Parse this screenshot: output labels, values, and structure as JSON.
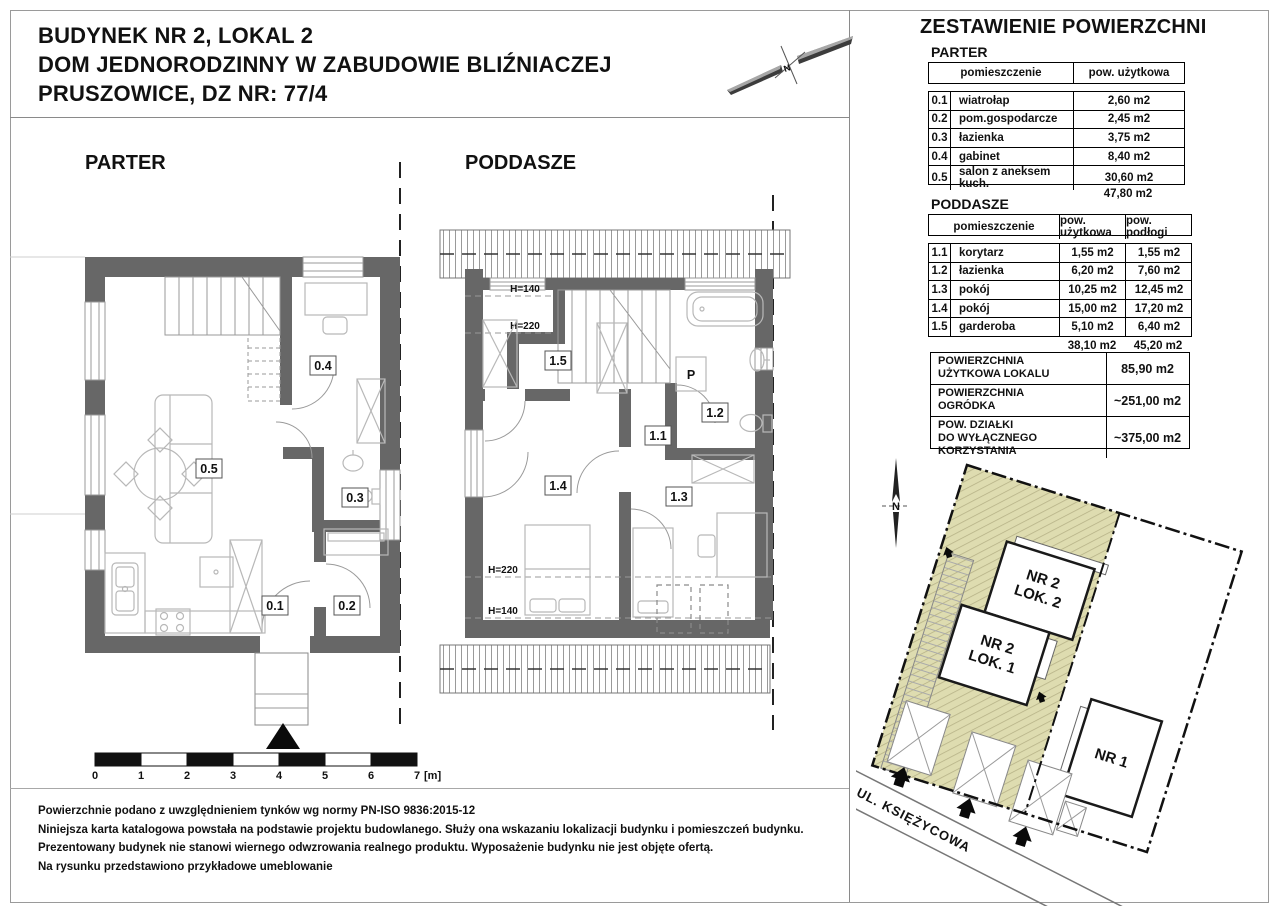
{
  "header": {
    "title_line1": "BUDYNEK NR 2, LOKAL 2",
    "title_line2": "DOM JEDNORODZINNY W ZABUDOWIE BLIŹNIACZEJ",
    "title_line3": "PRUSZOWICE, DZ NR: 77/4"
  },
  "floor_plans": {
    "parter_title": "PARTER",
    "poddasze_title": "PODDASZE",
    "parter_room_numbers": [
      "0.1",
      "0.2",
      "0.3",
      "0.4",
      "0.5"
    ],
    "poddasze_room_numbers": [
      "1.1",
      "1.2",
      "1.3",
      "1.4",
      "1.5"
    ],
    "washer_label": "P",
    "h140": "H=140",
    "h220": "H=220"
  },
  "scale_bar": {
    "ticks": [
      "0",
      "1",
      "2",
      "3",
      "4",
      "5",
      "6",
      "7"
    ],
    "unit": "[m]"
  },
  "tables": {
    "main_title": "ZESTAWIENIE POWIERZCHNI",
    "parter": {
      "section": "PARTER",
      "col_room": "pomieszczenie",
      "col_area": "pow. użytkowa",
      "rows": [
        {
          "no": "0.1",
          "name": "wiatrołap",
          "area": "2,60 m2"
        },
        {
          "no": "0.2",
          "name": "pom.gospodarcze",
          "area": "2,45 m2"
        },
        {
          "no": "0.3",
          "name": "łazienka",
          "area": "3,75 m2"
        },
        {
          "no": "0.4",
          "name": "gabinet",
          "area": "8,40 m2"
        },
        {
          "no": "0.5",
          "name": "salon z aneksem kuch.",
          "area": "30,60 m2"
        }
      ],
      "total_area": "47,80 m2"
    },
    "poddasze": {
      "section": "PODDASZE",
      "col_room": "pomieszczenie",
      "col_area": "pow. użytkowa",
      "col_floor": "pow. podłogi",
      "rows": [
        {
          "no": "1.1",
          "name": "korytarz",
          "area": "1,55 m2",
          "floor": "1,55 m2"
        },
        {
          "no": "1.2",
          "name": "łazienka",
          "area": "6,20 m2",
          "floor": "7,60 m2"
        },
        {
          "no": "1.3",
          "name": "pokój",
          "area": "10,25 m2",
          "floor": "12,45 m2"
        },
        {
          "no": "1.4",
          "name": "pokój",
          "area": "15,00 m2",
          "floor": "17,20 m2"
        },
        {
          "no": "1.5",
          "name": "garderoba",
          "area": "5,10 m2",
          "floor": "6,40 m2"
        }
      ],
      "total_area": "38,10 m2",
      "total_floor": "45,20 m2"
    },
    "summary": [
      {
        "label_line1": "POWIERZCHNIA",
        "label_line2": "UŻYTKOWA LOKALU",
        "value": "85,90 m2"
      },
      {
        "label_line1": "POWIERZCHNIA",
        "label_line2": "OGRÓDKA",
        "value": "~251,00 m2"
      },
      {
        "label_line1": "POW. DZIAŁKI",
        "label_line2": "DO WYŁĄCZNEGO KORZYSTANIA",
        "value": "~375,00 m2"
      }
    ]
  },
  "site_plan": {
    "north_label": "N",
    "building_nr2_lok2_line1": "NR 2",
    "building_nr2_lok2_line2": "LOK. 2",
    "building_nr2_lok1_line1": "NR 2",
    "building_nr2_lok1_line2": "LOK. 1",
    "building_nr1": "NR 1",
    "street": "UL. KSIĘŻYCOWA",
    "colors": {
      "parcel_green": "#dedcb0",
      "hatch_line": "#b6b287",
      "wall_gray": "#676767"
    }
  },
  "footer": {
    "lines": [
      "Powierzchnie podano z uwzględnieniem tynków wg normy PN-ISO 9836:2015-12",
      "Niniejsza karta katalogowa powstała na podstawie projektu budowlanego. Służy ona wskazaniu lokalizacji budynku i pomieszczeń budynku.",
      "Prezentowany budynek nie stanowi wiernego odwzrowania realnego produktu. Wyposażenie budynku nie jest objęte ofertą.",
      "Na rysunku przedstawiono przykładowe umeblowanie"
    ]
  }
}
